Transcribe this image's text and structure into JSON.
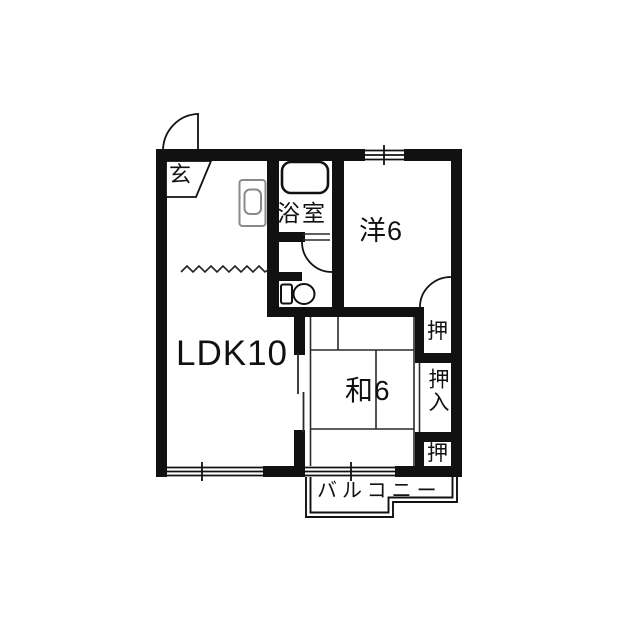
{
  "plan": {
    "rooms": {
      "genkan": {
        "label": "玄"
      },
      "bathroom": {
        "label": "浴室"
      },
      "western_room": {
        "label": "洋6"
      },
      "ldk": {
        "label": "LDK10"
      },
      "japanese_room": {
        "label": "和6"
      },
      "closet_top": {
        "label": "押"
      },
      "closet_middle": {
        "label": "押入"
      },
      "closet_bottom": {
        "label": "押"
      },
      "balcony": {
        "label": "バルコニー"
      }
    },
    "colors": {
      "wall": "#111111",
      "thin_line": "#2a2a2a",
      "background": "#ffffff",
      "fixture_gray": "#8a8a8a"
    }
  }
}
